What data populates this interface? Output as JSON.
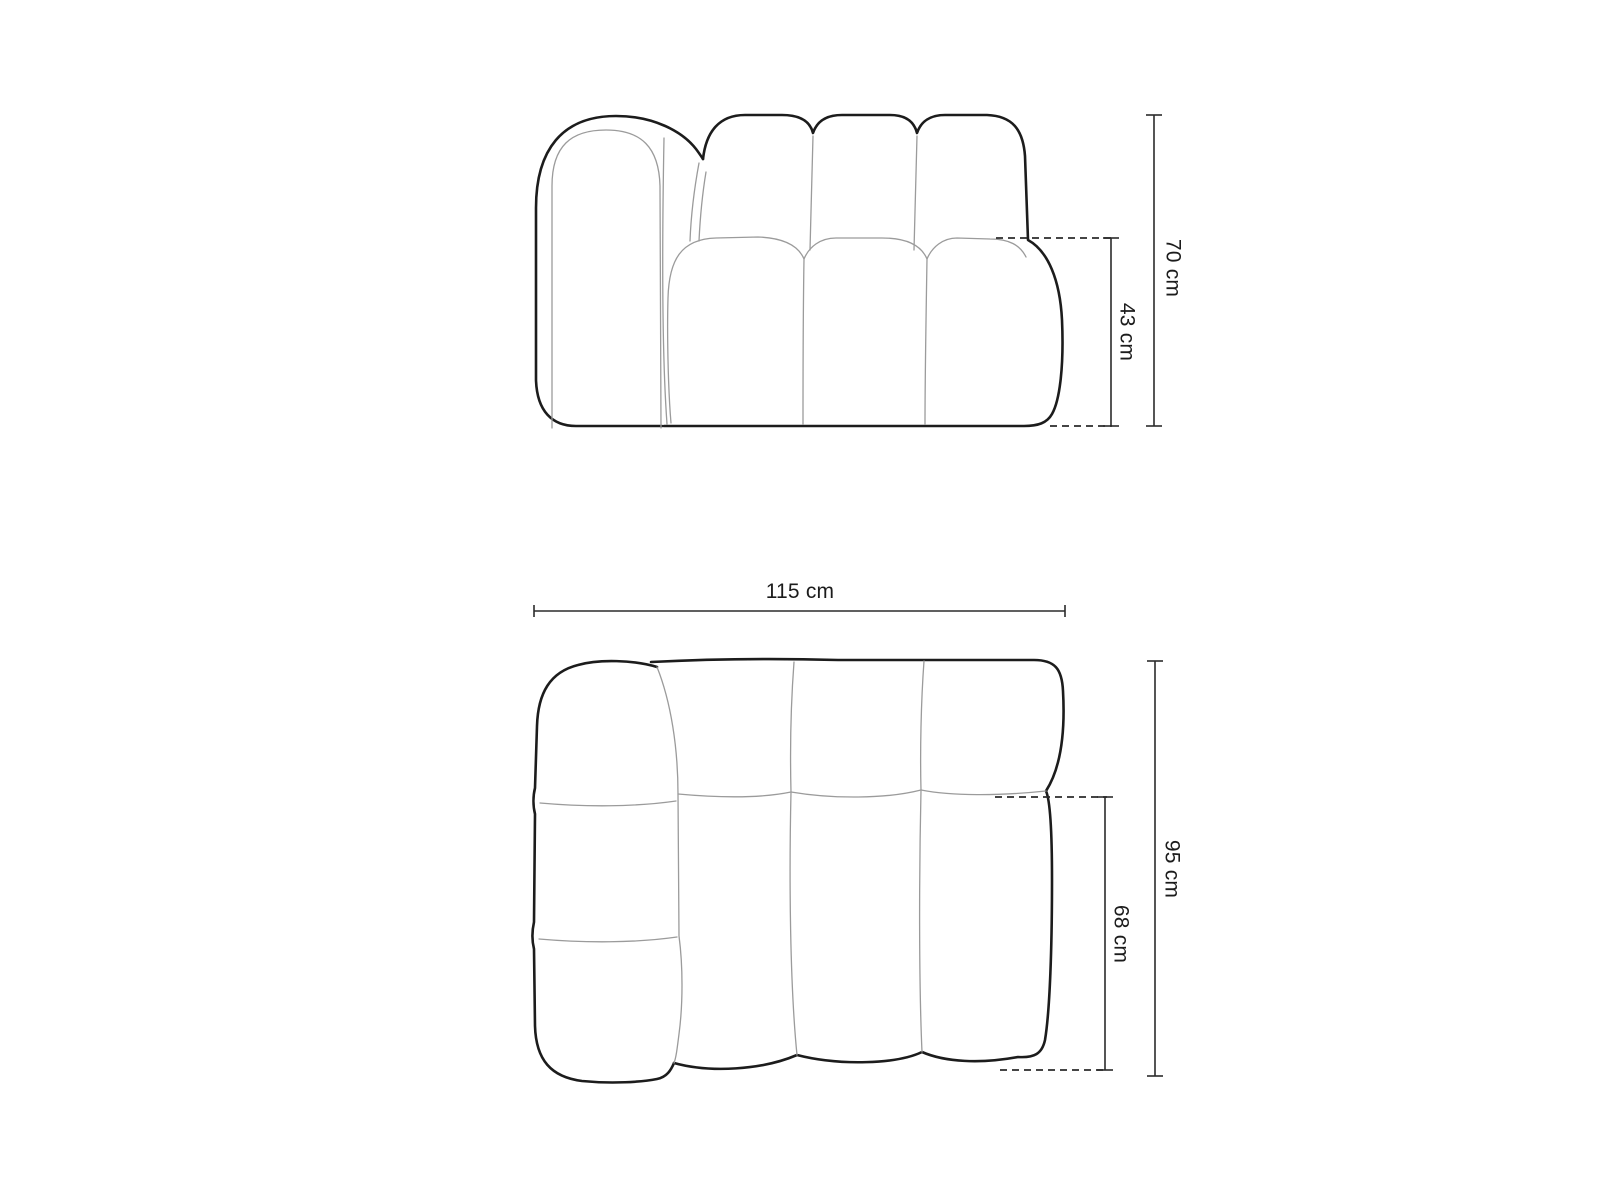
{
  "diagram": {
    "colors": {
      "outline": "#1c1c1c",
      "seam": "#9b9b9b",
      "dimension": "#2b2b2b",
      "text": "#1c1c1c",
      "background": "#ffffff"
    },
    "front_view": {
      "labels": {
        "total_height": "70 cm",
        "seat_height": "43 cm"
      }
    },
    "top_view": {
      "labels": {
        "total_width": "115 cm",
        "total_depth": "95 cm",
        "seat_depth": "68 cm"
      }
    }
  }
}
